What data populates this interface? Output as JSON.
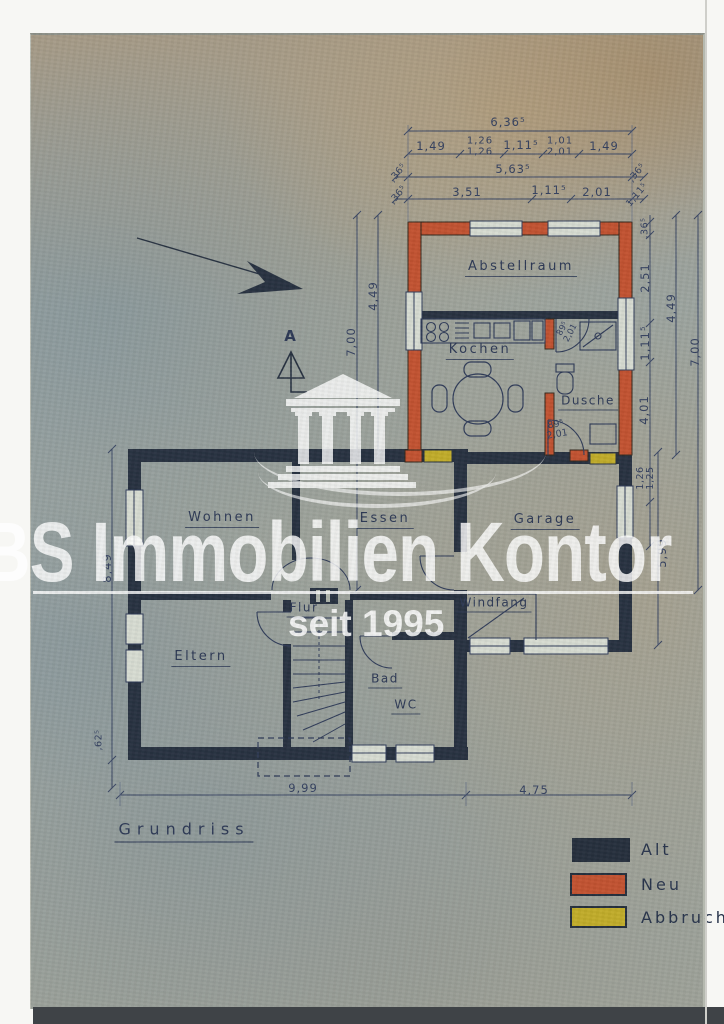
{
  "title": "Grundriss",
  "watermark": {
    "brand": "BS Immobilien Kontor",
    "since": "seit 1995"
  },
  "marker": {
    "section": "A"
  },
  "rooms": {
    "abstellraum": "Abstellraum",
    "kochen": "Kochen",
    "dusche": "Dusche",
    "wohnen": "Wohnen",
    "essen": "Essen",
    "garage": "Garage",
    "flur": "Flur",
    "windfang": "Windfang",
    "eltern": "Eltern",
    "bad": "Bad",
    "wc": "WC"
  },
  "legend": {
    "alt": {
      "label": "Alt",
      "color": "#242d3b"
    },
    "neu": {
      "label": "Neu",
      "color": "#c1512f"
    },
    "abbruch": {
      "label": "Abbruch",
      "color": "#c0ab28"
    }
  },
  "dims": {
    "top_total": "6,36⁵",
    "top2": [
      "1,49",
      "1,26\n1,26",
      "1,11⁵",
      "1,01\n2,01",
      "1,49"
    ],
    "top3": [
      ",36⁵",
      "5,63⁵",
      ",36⁵"
    ],
    "top4": [
      ",36⁵",
      "3,51",
      "1,11⁵",
      "2,01",
      ",36⁵"
    ],
    "annex_left_outer": "7,00",
    "annex_left_inner": "4,49",
    "annex_right": [
      ",36⁵",
      "2,51",
      "1,11⁵",
      "4,01",
      "1,26\n1,25"
    ],
    "annex_right_mid": "4,49",
    "annex_right_outer": "7,00",
    "garage_right": "5,99",
    "house_left": "8,49",
    "house_left_small": ",62⁵",
    "bottom_main": "9,99",
    "bottom_garage": "4,75",
    "door_upper": "89⁵\n2,01",
    "door_lower": "89⁵\n2,01"
  }
}
